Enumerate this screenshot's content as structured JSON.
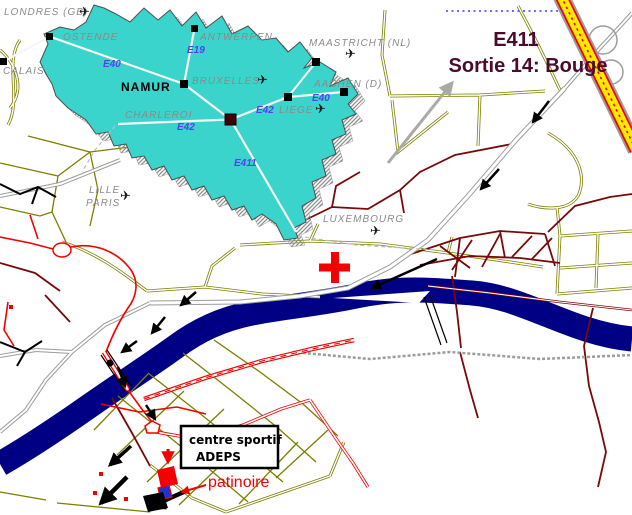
{
  "colors": {
    "inset_fill": "#3bd4cc",
    "inset_shadow": "#8f8f8f",
    "water": "#000085",
    "road_olive": "#7e7e00",
    "road_bright_red": "#f50000",
    "road_dark_red": "#7a0808",
    "road_gray": "#9c9c9c",
    "highway_yellow": "#ffeb00",
    "eroad_label_blue": "#5340f0",
    "city_label_gray": "#8a8a8a",
    "exit_text": "#4b0a2e",
    "cross_marker": "#f50000",
    "rink_marker_blue": "#2233cc"
  },
  "icons": {
    "airplane": "✈"
  },
  "inset": {
    "cities": [
      {
        "name": "LONDRES (GB)"
      },
      {
        "name": "OSTENDE"
      },
      {
        "name": "CALAIS"
      },
      {
        "name": "ANTWERPEN"
      },
      {
        "name": "MAASTRICHT (NL)"
      },
      {
        "name": "BRUXELLES"
      },
      {
        "name": "AACHEN (D)"
      },
      {
        "name": "NAMUR"
      },
      {
        "name": "CHARLEROI"
      },
      {
        "name": "LIEGE"
      },
      {
        "name": "LILLE"
      },
      {
        "name": "PARIS"
      },
      {
        "name": "LUXEMBOURG"
      }
    ],
    "eroads": [
      {
        "label": "E40"
      },
      {
        "label": "E19"
      },
      {
        "label": "E42"
      },
      {
        "label": "E42"
      },
      {
        "label": "E40"
      },
      {
        "label": "E411"
      }
    ]
  },
  "callouts": {
    "exit_line1": "E411",
    "exit_line2": "Sortie 14: Bouge",
    "venue_line1": "centre sportif",
    "venue_line2": "ADEPS",
    "rink_label": "patinoire"
  }
}
